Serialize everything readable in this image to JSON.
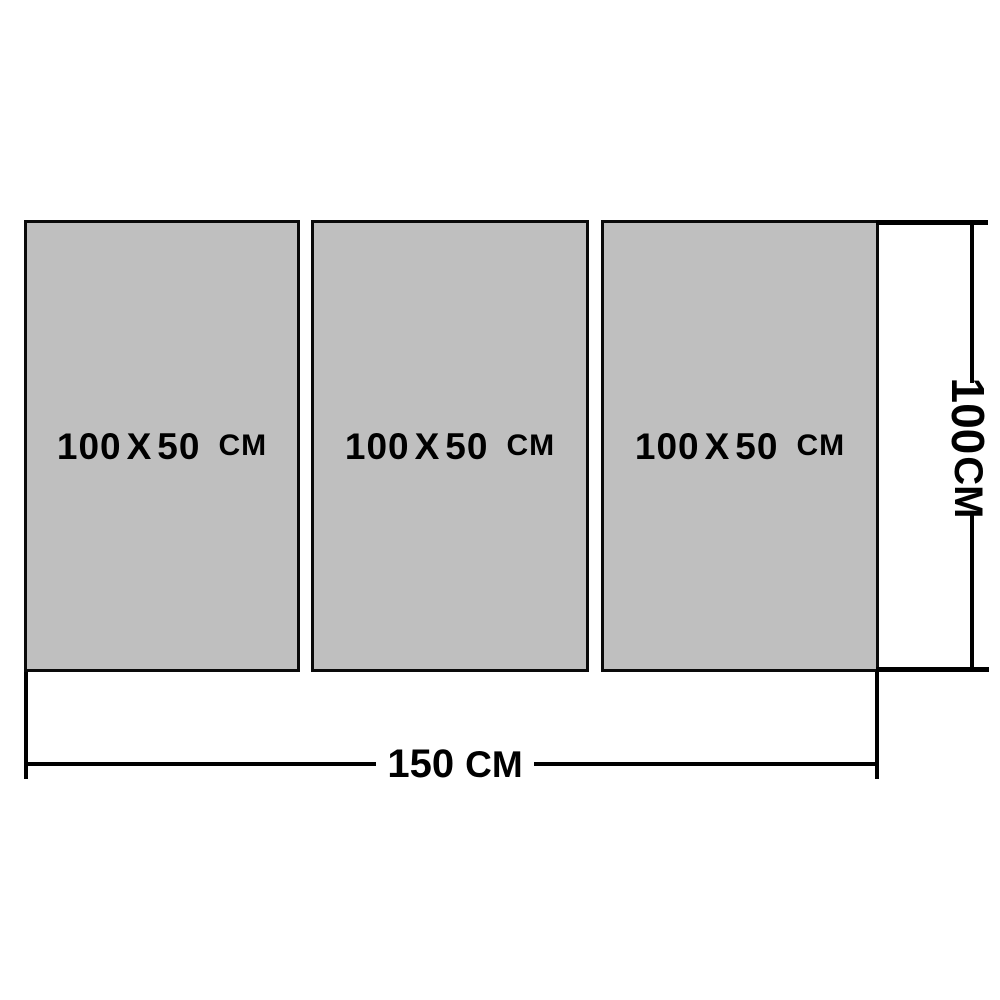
{
  "diagram": {
    "panels": [
      {
        "height": "100",
        "separator": "X",
        "width": "50",
        "unit": "CM"
      },
      {
        "height": "100",
        "separator": "X",
        "width": "50",
        "unit": "CM"
      },
      {
        "height": "100",
        "separator": "X",
        "width": "50",
        "unit": "CM"
      }
    ],
    "dimensions": {
      "total_width": {
        "value": "150",
        "unit": "CM"
      },
      "total_height": {
        "value": "100",
        "unit": "CM"
      }
    },
    "colors": {
      "panel_fill": "#bfbfbf",
      "line": "#000000",
      "text": "#000000",
      "background": "#ffffff"
    }
  }
}
